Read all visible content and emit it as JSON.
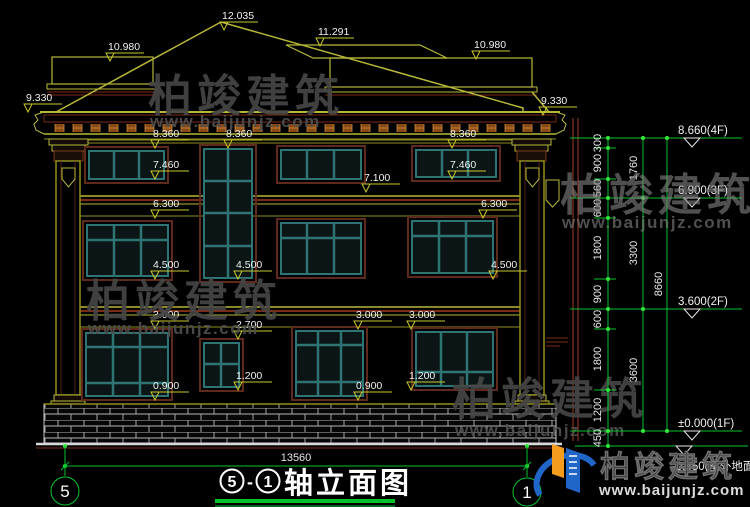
{
  "drawing": {
    "title": {
      "axis_left": "5",
      "separator": "-",
      "axis_right": "1",
      "name": "轴立面图"
    },
    "overall_width": "13560",
    "axis_bubble_left": "5",
    "axis_bubble_right": "1"
  },
  "markers": {
    "roof_peak": "12.035",
    "roof_left_flat": "10.980",
    "roof_right_ridge": "11.291",
    "roof_right_flat": "10.980",
    "eave_left": "9.330",
    "eave_right": "9.330",
    "win_top_4f_left": "8.360",
    "win_top_4f_stair": "8.360",
    "win_top_4f_right": "8.360",
    "sill_4f_left": "7.460",
    "sill_4f_right": "7.460",
    "band_7100": "7.100",
    "win_top_3f_left": "6.300",
    "win_top_3f_right": "6.300",
    "sill_3f_left": "4.500",
    "sill_3f_stair": "4.500",
    "sill_3f_right": "4.500",
    "win_top_1f_left": "3.000",
    "win_top_1f_mid": "3.000",
    "win_top_1f_right": "3.000",
    "win_top_stair_1f": "2.700",
    "sill_stair_1f": "1.200",
    "sill_1f_right": "1.200",
    "sill_1f_left": "0.900",
    "sill_1f_mid": "0.900"
  },
  "levels": {
    "f4": "8.660(4F)",
    "f3": "6.900(3F)",
    "f2": "3.600(2F)",
    "f1": "±0.000(1F)",
    "ground": "-0.450(室外地面)"
  },
  "dims": {
    "chain_inner": [
      "300",
      "900",
      "560",
      "600",
      "1800",
      "900",
      "600",
      "1800",
      "1200",
      "450"
    ],
    "chain_floor": [
      "1760",
      "3300",
      "3600"
    ],
    "total": "8660"
  },
  "watermark": {
    "brand": "柏竣建筑",
    "url": "www.baijunjz.com"
  }
}
